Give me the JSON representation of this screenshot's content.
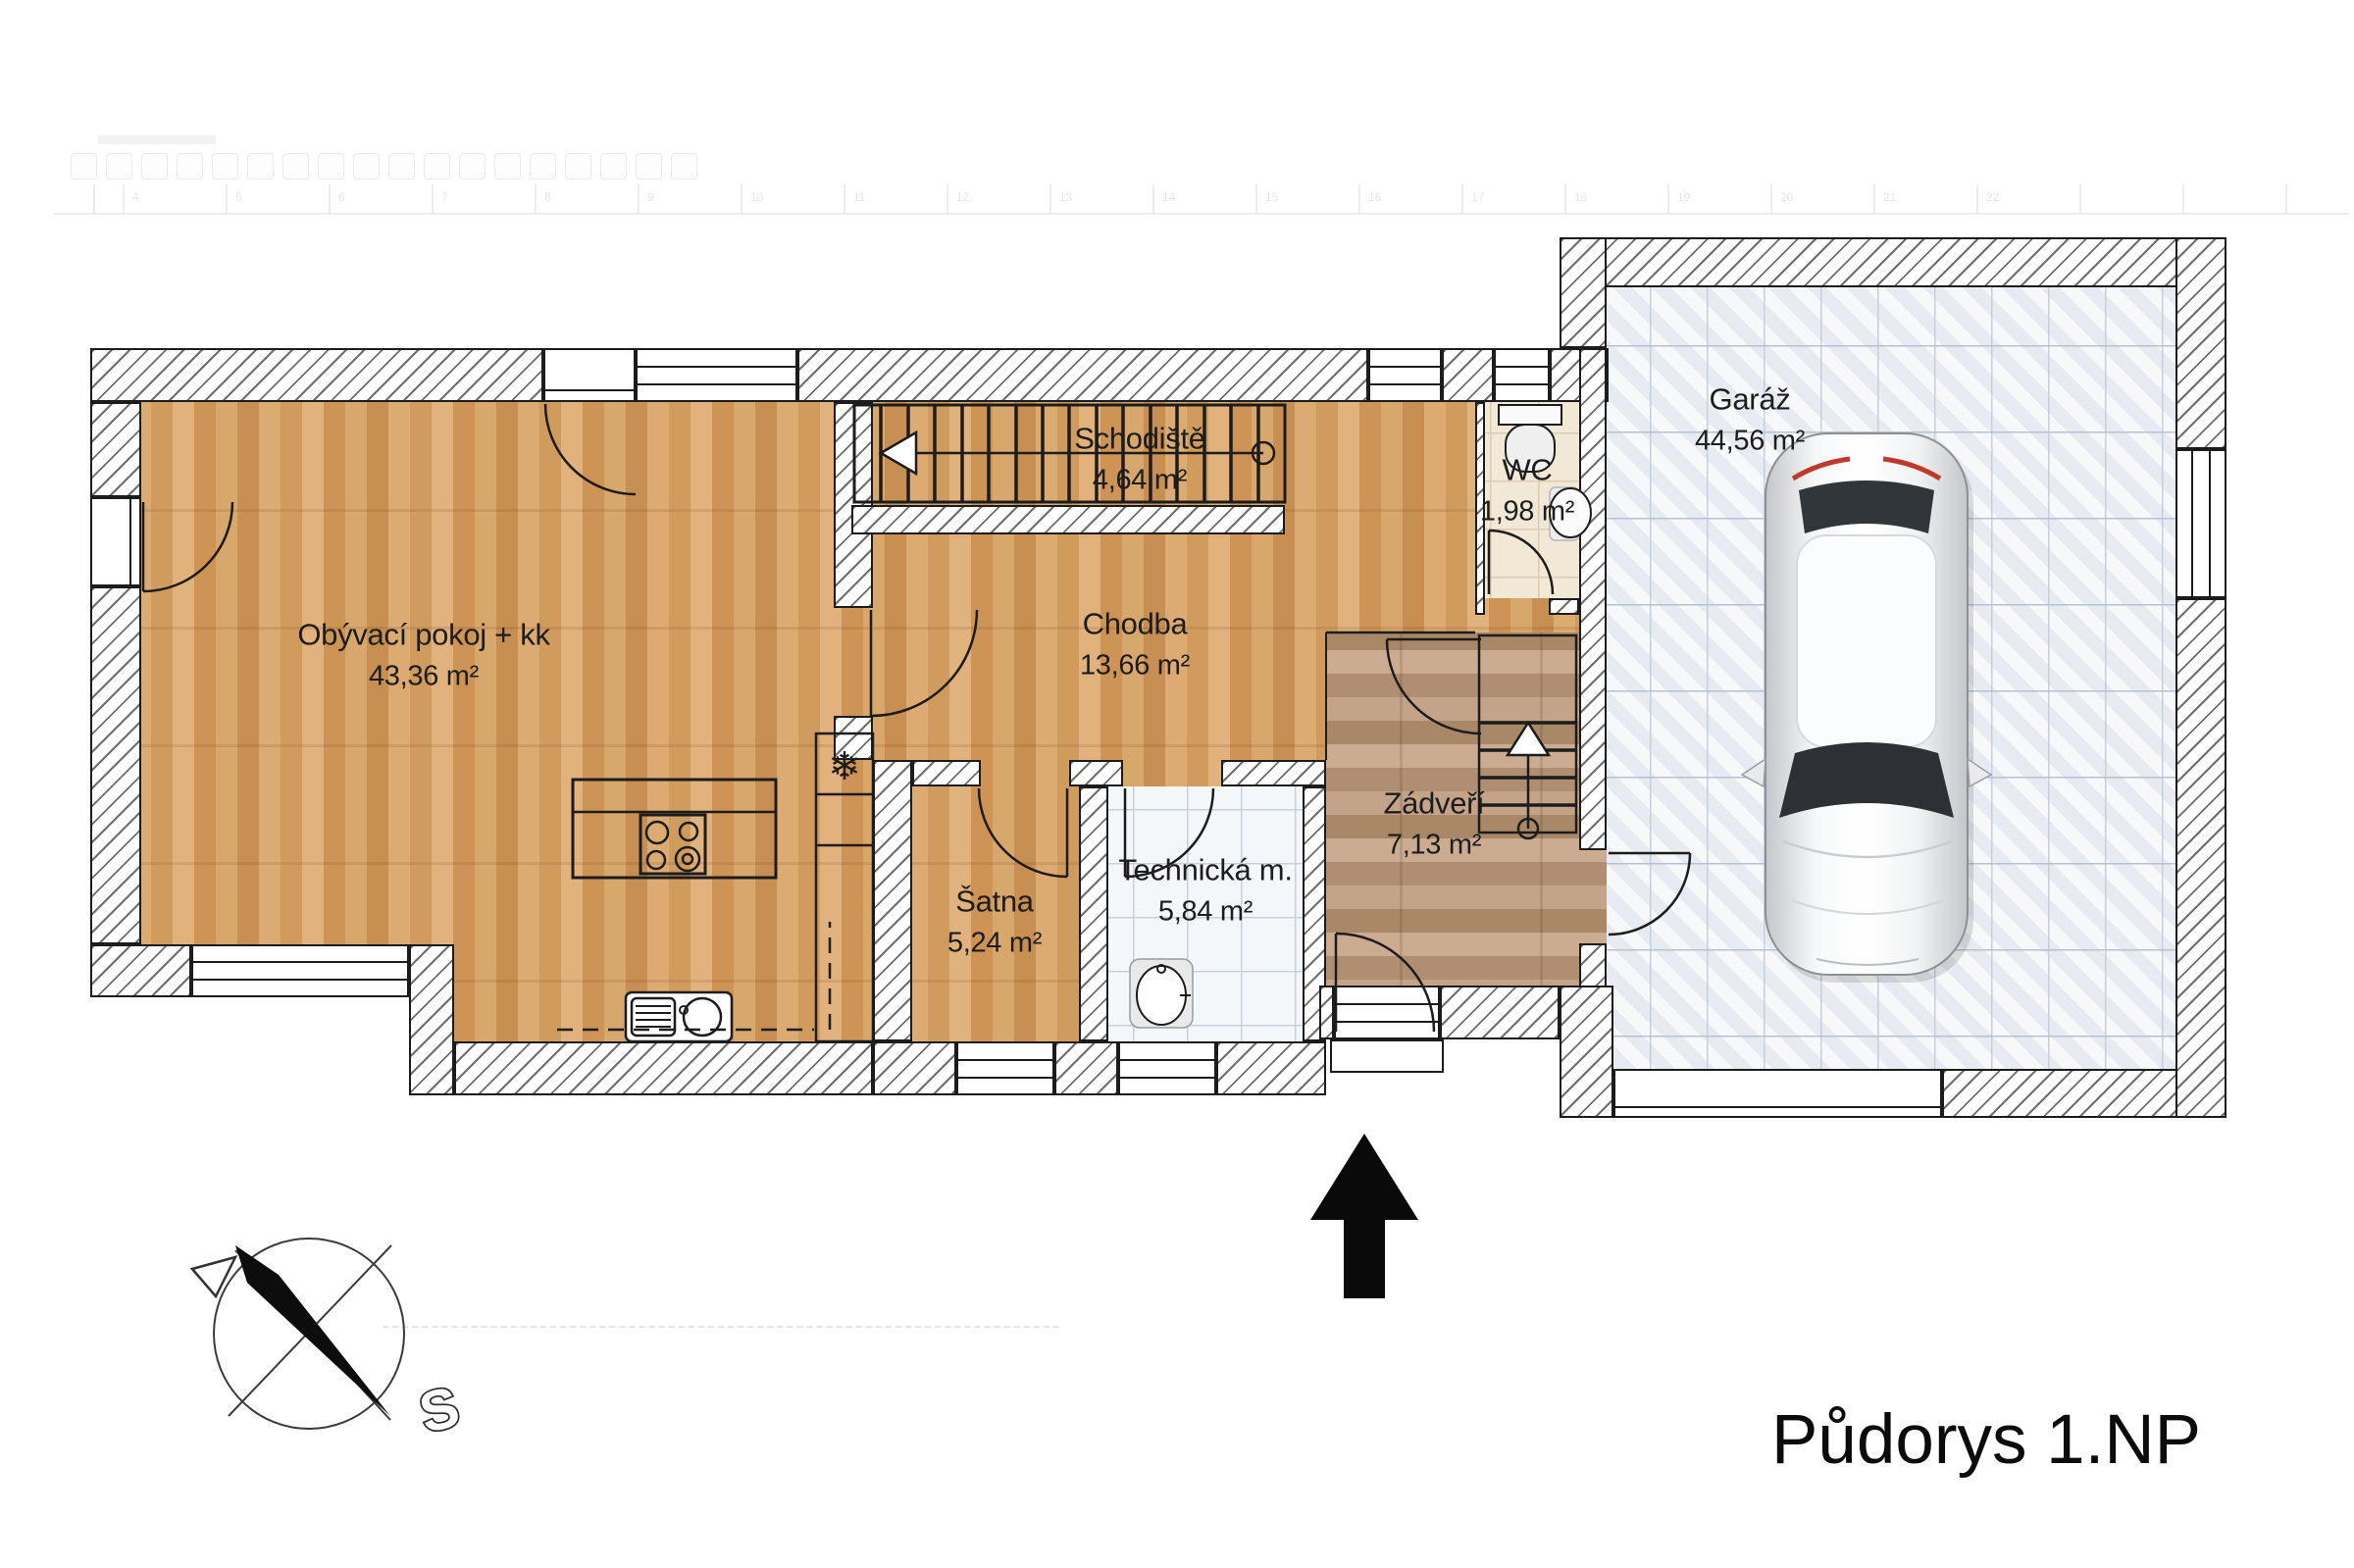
{
  "title": "Půdorys 1.NP",
  "compass": {
    "north_label": "S"
  },
  "rooms": {
    "living": {
      "name": "Obývací pokoj + kk",
      "area": "43,36 m²"
    },
    "stairs": {
      "name": "Schodiště",
      "area": "4,64 m²"
    },
    "hall": {
      "name": "Chodba",
      "area": "13,66 m²"
    },
    "wc": {
      "name": "WC",
      "area": "1,98 m²"
    },
    "garage": {
      "name": "Garáž",
      "area": "44,56 m²"
    },
    "wardrobe": {
      "name": "Šatna",
      "area": "5,24 m²"
    },
    "technical": {
      "name": "Technická m.",
      "area": "5,84 m²"
    },
    "entry": {
      "name": "Zádveří",
      "area": "7,13 m²"
    }
  },
  "icons": {
    "fridge": "❄"
  },
  "ghost_ruler": {
    "numbers": [
      "4",
      "5",
      "6",
      "7",
      "8",
      "9",
      "10",
      "11",
      "12",
      "13",
      "14",
      "15",
      "16",
      "17",
      "18",
      "19",
      "20",
      "21",
      "22"
    ]
  },
  "colors": {
    "wood": "#d8a668",
    "wood_grey": "#bd9d82",
    "tile_garage": "#edf0f5",
    "tile_tech": "#f4f7fa",
    "tile_wc": "#f2e8d6",
    "line": "#1c1c1c"
  }
}
